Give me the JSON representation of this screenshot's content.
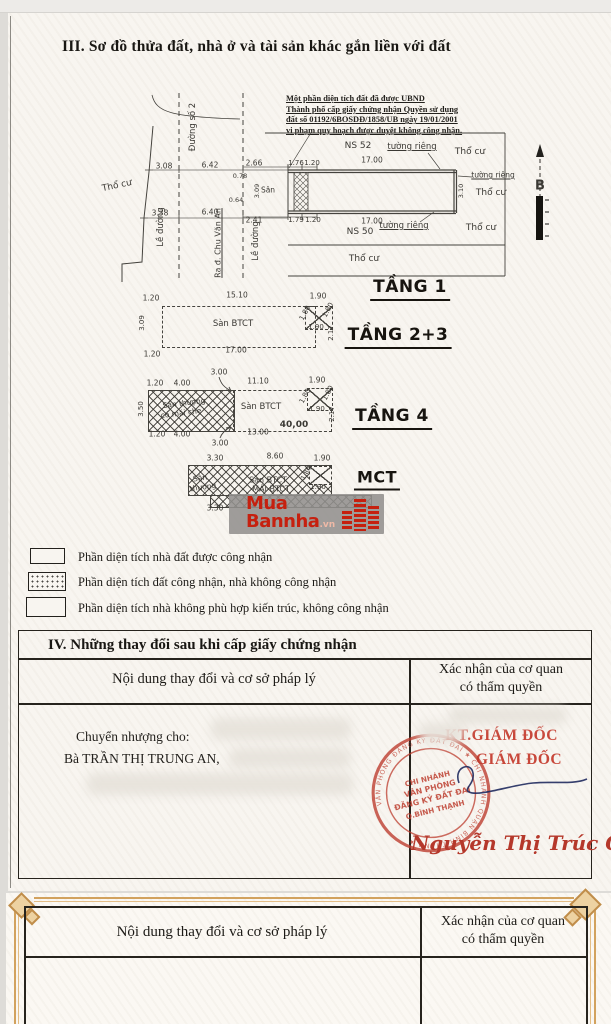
{
  "document": {
    "section3_title": "III. Sơ đồ thửa đất, nhà ở và tài sản khác gắn liền với đất",
    "note_lines": [
      "Một phần diện tích đất đã được UBND",
      "Thành phố cấp giấy chứng nhận Quyền sử dụng",
      "đất số 01192/6BOSDĐ/1858/UB ngày 19/01/2001",
      "vi phạm quy hoạch được duyệt không công nhận."
    ]
  },
  "siteplan": {
    "labels": [
      {
        "t": "Thổ cư",
        "x": 117,
        "y": 186,
        "r": -12,
        "fs": 9
      },
      {
        "t": "Đường số 2",
        "x": 193,
        "y": 127,
        "r": -90,
        "fs": 8.5
      },
      {
        "t": "Lề đường",
        "x": 161,
        "y": 227,
        "r": -90,
        "fs": 8.5
      },
      {
        "t": "Ra đ. Chu Văn An",
        "x": 218,
        "y": 243,
        "r": -90,
        "fs": 8,
        "u": true
      },
      {
        "t": "Lề đường",
        "x": 256,
        "y": 241,
        "r": -90,
        "fs": 8.5
      },
      {
        "t": "3.08",
        "x": 164,
        "y": 166,
        "fs": 7.5
      },
      {
        "t": "6.42",
        "x": 210,
        "y": 165,
        "fs": 7.5
      },
      {
        "t": "3.38",
        "x": 160,
        "y": 213,
        "fs": 7.5
      },
      {
        "t": "6.40",
        "x": 210,
        "y": 212,
        "fs": 7.5
      },
      {
        "t": "2.66",
        "x": 254,
        "y": 163,
        "fs": 7.5
      },
      {
        "t": "2.41",
        "x": 254,
        "y": 220,
        "fs": 7.5
      },
      {
        "t": "1.76",
        "x": 296,
        "y": 163,
        "fs": 7
      },
      {
        "t": "1.20",
        "x": 312,
        "y": 163,
        "fs": 7
      },
      {
        "t": "1.79",
        "x": 296,
        "y": 220,
        "fs": 7
      },
      {
        "t": "1.20",
        "x": 313,
        "y": 220,
        "fs": 7
      },
      {
        "t": "17.00",
        "x": 372,
        "y": 160,
        "fs": 7.5
      },
      {
        "t": "17.00",
        "x": 372,
        "y": 221,
        "fs": 7.5
      },
      {
        "t": "NS 52",
        "x": 358,
        "y": 146,
        "fs": 9
      },
      {
        "t": "NS 50",
        "x": 360,
        "y": 232,
        "fs": 9
      },
      {
        "t": "tường riêng",
        "x": 412,
        "y": 147,
        "fs": 8.5,
        "u": true
      },
      {
        "t": "tường riêng",
        "x": 493,
        "y": 175,
        "fs": 7.5,
        "u": true
      },
      {
        "t": "tường riêng",
        "x": 404,
        "y": 226,
        "fs": 8.5,
        "u": true
      },
      {
        "t": "Thổ cư",
        "x": 470,
        "y": 152,
        "fs": 9
      },
      {
        "t": "Thổ cư",
        "x": 491,
        "y": 193,
        "fs": 9
      },
      {
        "t": "Thổ cư",
        "x": 481,
        "y": 228,
        "fs": 9
      },
      {
        "t": "Thổ cư",
        "x": 364,
        "y": 259,
        "fs": 9
      },
      {
        "t": "Sân",
        "x": 268,
        "y": 190,
        "fs": 7.5
      },
      {
        "t": "0.78",
        "x": 240,
        "y": 176,
        "fs": 6.5
      },
      {
        "t": "0.64",
        "x": 236,
        "y": 200,
        "fs": 6.5
      },
      {
        "t": "3.09",
        "x": 257,
        "y": 191,
        "r": -90,
        "fs": 6.5
      },
      {
        "t": "3.10",
        "x": 461,
        "y": 191,
        "r": -90,
        "fs": 6.5
      },
      {
        "t": "B",
        "x": 540,
        "y": 186,
        "fs": 13,
        "b": true,
        "n": "north-label"
      }
    ]
  },
  "floors": {
    "tang1_label": "TẦNG 1",
    "tang23_label": "TẦNG 2+3",
    "tang4_label": "TẦNG 4",
    "mct_label": "MCT",
    "tang23_dims": [
      {
        "t": "1.20",
        "x": 151,
        "y": 298,
        "fs": 7.5
      },
      {
        "t": "15.10",
        "x": 237,
        "y": 295,
        "fs": 7.5
      },
      {
        "t": "1.90",
        "x": 318,
        "y": 296,
        "fs": 7.5
      },
      {
        "t": "1.80",
        "x": 305,
        "y": 313,
        "r": -62,
        "fs": 7
      },
      {
        "t": "1.80",
        "x": 328,
        "y": 310,
        "r": -62,
        "fs": 7
      },
      {
        "t": "1.90",
        "x": 316,
        "y": 327,
        "fs": 7
      },
      {
        "t": "2.17",
        "x": 331,
        "y": 333,
        "r": -90,
        "fs": 7
      },
      {
        "t": "Sàn BTCT",
        "x": 233,
        "y": 324,
        "fs": 8.5
      },
      {
        "t": "17.00",
        "x": 236,
        "y": 350,
        "fs": 7.5
      },
      {
        "t": "1.20",
        "x": 152,
        "y": 354,
        "fs": 7.5
      },
      {
        "t": "3.09",
        "x": 142,
        "y": 323,
        "r": -90,
        "fs": 7
      }
    ],
    "tang4_dims": [
      {
        "t": "3.00",
        "x": 219,
        "y": 372,
        "fs": 7.5
      },
      {
        "t": "1.20",
        "x": 155,
        "y": 383,
        "fs": 7.5
      },
      {
        "t": "4.00",
        "x": 182,
        "y": 383,
        "fs": 7.5
      },
      {
        "t": "11.10",
        "x": 258,
        "y": 381,
        "fs": 7.5
      },
      {
        "t": "1.90",
        "x": 317,
        "y": 380,
        "fs": 7.5
      },
      {
        "t": "Sân thượng",
        "x": 184,
        "y": 403,
        "r": -7,
        "fs": 7.5
      },
      {
        "t": "có mái che",
        "x": 181,
        "y": 413,
        "r": -7,
        "fs": 7.5
      },
      {
        "t": "Sàn BTCT",
        "x": 261,
        "y": 407,
        "fs": 8.5
      },
      {
        "t": "1.80",
        "x": 305,
        "y": 396,
        "r": -62,
        "fs": 7
      },
      {
        "t": "1.80",
        "x": 328,
        "y": 393,
        "r": -62,
        "fs": 7
      },
      {
        "t": "1.90",
        "x": 317,
        "y": 409,
        "fs": 7
      },
      {
        "t": "2.17",
        "x": 332,
        "y": 414,
        "r": -90,
        "fs": 7
      },
      {
        "t": "3.50",
        "x": 141,
        "y": 409,
        "r": -90,
        "fs": 7
      },
      {
        "t": "1.20",
        "x": 157,
        "y": 434,
        "fs": 7.5
      },
      {
        "t": "4.00",
        "x": 182,
        "y": 434,
        "fs": 7.5
      },
      {
        "t": "13.00",
        "x": 258,
        "y": 432,
        "fs": 7.5
      },
      {
        "t": "40,00",
        "x": 294,
        "y": 425,
        "fs": 9,
        "b": true
      },
      {
        "t": "3.00",
        "x": 220,
        "y": 443,
        "fs": 7.5
      }
    ],
    "mct_dims": [
      {
        "t": "3.30",
        "x": 215,
        "y": 458,
        "fs": 7.5
      },
      {
        "t": "8.60",
        "x": 275,
        "y": 456,
        "fs": 7.5
      },
      {
        "t": "1.90",
        "x": 322,
        "y": 458,
        "fs": 7.5
      },
      {
        "t": "Sân",
        "x": 200,
        "y": 478,
        "r": -8,
        "fs": 7.5
      },
      {
        "t": "thượng",
        "x": 203,
        "y": 487,
        "r": -8,
        "fs": 7.5
      },
      {
        "t": "Sàn BTCT",
        "x": 268,
        "y": 480,
        "fs": 8
      },
      {
        "t": "MÁI BTCT",
        "x": 271,
        "y": 489,
        "fs": 8
      },
      {
        "t": "1.80",
        "x": 306,
        "y": 473,
        "r": -62,
        "fs": 6.5
      },
      {
        "t": "1.90",
        "x": 318,
        "y": 487,
        "fs": 7
      },
      {
        "t": "3.30",
        "x": 215,
        "y": 508,
        "fs": 7.5
      }
    ]
  },
  "watermark": {
    "word1": "Mua",
    "word2": "Bannha",
    "suffix": ".vn"
  },
  "legend": {
    "items": [
      {
        "label": "Phần diện tích nhà đất được công nhận"
      },
      {
        "label": "Phần diện tích đất công nhận, nhà không công nhận"
      },
      {
        "label": "Phần diện tích nhà không phù hợp kiến trúc, không công nhận"
      }
    ]
  },
  "section4": {
    "title": "IV. Những thay đổi sau khi cấp giấy chứng nhận",
    "col_left": "Nội dung thay đổi và cơ sở pháp lý",
    "col_right_line1": "Xác nhận của cơ quan",
    "col_right_line2": "có thẩm quyền",
    "transfer_label": "Chuyển nhượng cho:",
    "transfer_name": "Bà TRẦN THỊ TRUNG AN,",
    "approver_line1": "KT.GIÁM ĐỐC",
    "approver_line2": "GIÁM ĐỐC",
    "stamp": {
      "line1": "CHI NHÁNH",
      "line2": "VĂN PHÒNG",
      "line3": "ĐĂNG KÝ ĐẤT ĐAI",
      "line4": "Q.BÌNH THẠNH",
      "ring_text": "VĂN PHÒNG ĐĂNG KÝ ĐẤT ĐAI ★ CHI NHÁNH QUẬN BÌNH THẠNH ★"
    },
    "signer_name": "Nguyễn Thị Trúc Cầm"
  },
  "page2": {
    "col_left": "Nội dung thay đổi và cơ sở pháp lý",
    "col_right_line1": "Xác nhận của cơ quan",
    "col_right_line2": "có thẩm quyền"
  }
}
